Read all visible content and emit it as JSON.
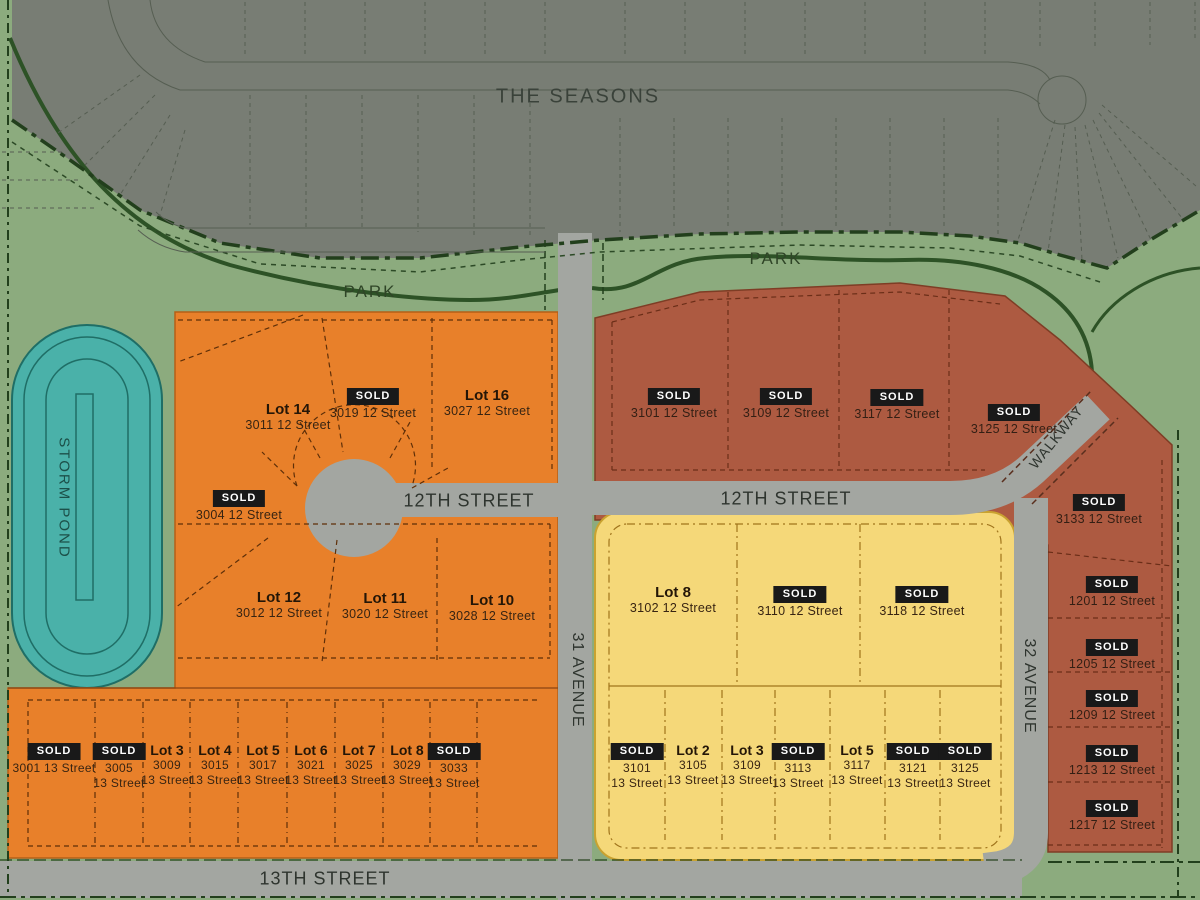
{
  "map_labels": {
    "the_seasons": "THE SEASONS",
    "park_west": "PARK",
    "park_east": "PARK",
    "storm_pond": "STORM POND",
    "walkway": "WALKWAY"
  },
  "streets": {
    "twelfth_west": "12TH STREET",
    "twelfth_east": "12TH STREET",
    "thirteenth": "13TH STREET",
    "avenue_31": "31 AVENUE",
    "avenue_32": "32 AVENUE"
  },
  "badge_text": "SOLD",
  "colors": {
    "park_green": "#8cab7e",
    "seasons_gray": "#787d74",
    "orange": "#e8802a",
    "red": "#ad5a41",
    "yellow": "#f5d879",
    "pond_teal": "#4ab1a9",
    "road_gray": "#a3a6a1",
    "badge_bg": "#191919",
    "badge_text_color": "#ffffff"
  },
  "lot_groups": {
    "orange_north": [
      {
        "lot": "Lot 14",
        "sold": false,
        "lines": [
          "3011 12 Street"
        ]
      },
      {
        "lot": null,
        "sold": true,
        "lines": [
          "3019 12 Street"
        ]
      },
      {
        "lot": "Lot 16",
        "sold": false,
        "lines": [
          "3027 12 Street"
        ]
      },
      {
        "lot": null,
        "sold": true,
        "lines": [
          "3004 12 Street"
        ]
      }
    ],
    "orange_mid": [
      {
        "lot": "Lot 12",
        "sold": false,
        "lines": [
          "3012 12 Street"
        ]
      },
      {
        "lot": "Lot 11",
        "sold": false,
        "lines": [
          "3020 12 Street"
        ]
      },
      {
        "lot": "Lot 10",
        "sold": false,
        "lines": [
          "3028 12 Street"
        ]
      }
    ],
    "orange_13th_row": [
      {
        "lot": null,
        "sold": true,
        "lines": [
          "3001 13 Street"
        ]
      },
      {
        "lot": null,
        "sold": true,
        "lines": [
          "3005",
          "13 Street"
        ]
      },
      {
        "lot": "Lot 3",
        "sold": false,
        "lines": [
          "3009",
          "13 Street"
        ]
      },
      {
        "lot": "Lot 4",
        "sold": false,
        "lines": [
          "3015",
          "13 Street"
        ]
      },
      {
        "lot": "Lot 5",
        "sold": false,
        "lines": [
          "3017",
          "13 Street"
        ]
      },
      {
        "lot": "Lot 6",
        "sold": false,
        "lines": [
          "3021",
          "13 Street"
        ]
      },
      {
        "lot": "Lot 7",
        "sold": false,
        "lines": [
          "3025",
          "13 Street"
        ]
      },
      {
        "lot": "Lot 8",
        "sold": false,
        "lines": [
          "3029",
          "13 Street"
        ]
      },
      {
        "lot": null,
        "sold": true,
        "lines": [
          "3033",
          "13 Street"
        ]
      }
    ],
    "red_12th_row": [
      {
        "lot": null,
        "sold": true,
        "lines": [
          "3101 12 Street"
        ]
      },
      {
        "lot": null,
        "sold": true,
        "lines": [
          "3109 12 Street"
        ]
      },
      {
        "lot": null,
        "sold": true,
        "lines": [
          "3117 12 Street"
        ]
      },
      {
        "lot": null,
        "sold": true,
        "lines": [
          "3125 12 Street"
        ]
      },
      {
        "lot": null,
        "sold": true,
        "lines": [
          "3133 12 Street"
        ]
      }
    ],
    "red_east_column": [
      {
        "lot": null,
        "sold": true,
        "lines": [
          "1201 12 Street"
        ]
      },
      {
        "lot": null,
        "sold": true,
        "lines": [
          "1205 12 Street"
        ]
      },
      {
        "lot": null,
        "sold": true,
        "lines": [
          "1209 12 Street"
        ]
      },
      {
        "lot": null,
        "sold": true,
        "lines": [
          "1213 12 Street"
        ]
      },
      {
        "lot": null,
        "sold": true,
        "lines": [
          "1217 12 Street"
        ]
      }
    ],
    "yellow_north": [
      {
        "lot": "Lot 8",
        "sold": false,
        "lines": [
          "3102 12 Street"
        ]
      },
      {
        "lot": null,
        "sold": true,
        "lines": [
          "3110 12 Street"
        ]
      },
      {
        "lot": null,
        "sold": true,
        "lines": [
          "3118 12 Street"
        ]
      }
    ],
    "yellow_13th_row": [
      {
        "lot": null,
        "sold": true,
        "lines": [
          "3101",
          "13 Street"
        ]
      },
      {
        "lot": "Lot 2",
        "sold": false,
        "lines": [
          "3105",
          "13 Street"
        ]
      },
      {
        "lot": "Lot 3",
        "sold": false,
        "lines": [
          "3109",
          "13 Street"
        ]
      },
      {
        "lot": null,
        "sold": true,
        "lines": [
          "3113",
          "13 Street"
        ]
      },
      {
        "lot": "Lot 5",
        "sold": false,
        "lines": [
          "3117",
          "13 Street"
        ]
      },
      {
        "lot": null,
        "sold": true,
        "lines": [
          "3121",
          "13 Street"
        ]
      },
      {
        "lot": null,
        "sold": true,
        "lines": [
          "3125",
          "13 Street"
        ]
      }
    ]
  }
}
